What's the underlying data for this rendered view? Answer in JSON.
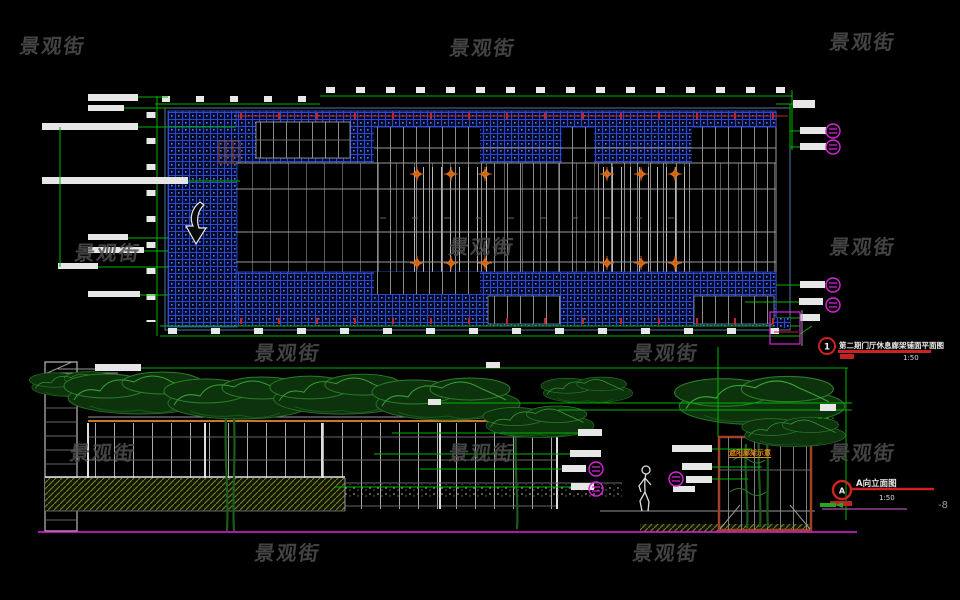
{
  "watermark": {
    "text": "景观街"
  },
  "plan_view": {
    "callout_number": "1",
    "title": "第二期门厅休息廊架铺面平面图",
    "scale": "1:50"
  },
  "elevation_view": {
    "marker_letter": "A",
    "title": "A向立面图",
    "scale": "1:50",
    "pergola_sign": "遮阳廊架示意",
    "edge_fragment": "-8"
  },
  "colors": {
    "hatch_blue": "#2a48d8",
    "dimension_green": "#00b400",
    "tick_red": "#cc2222",
    "callout_magenta": "#dd22dd",
    "marker_orange": "#e07820",
    "tree_green": "#2a7d2a",
    "watermark_gray": "#4f4f4f"
  }
}
